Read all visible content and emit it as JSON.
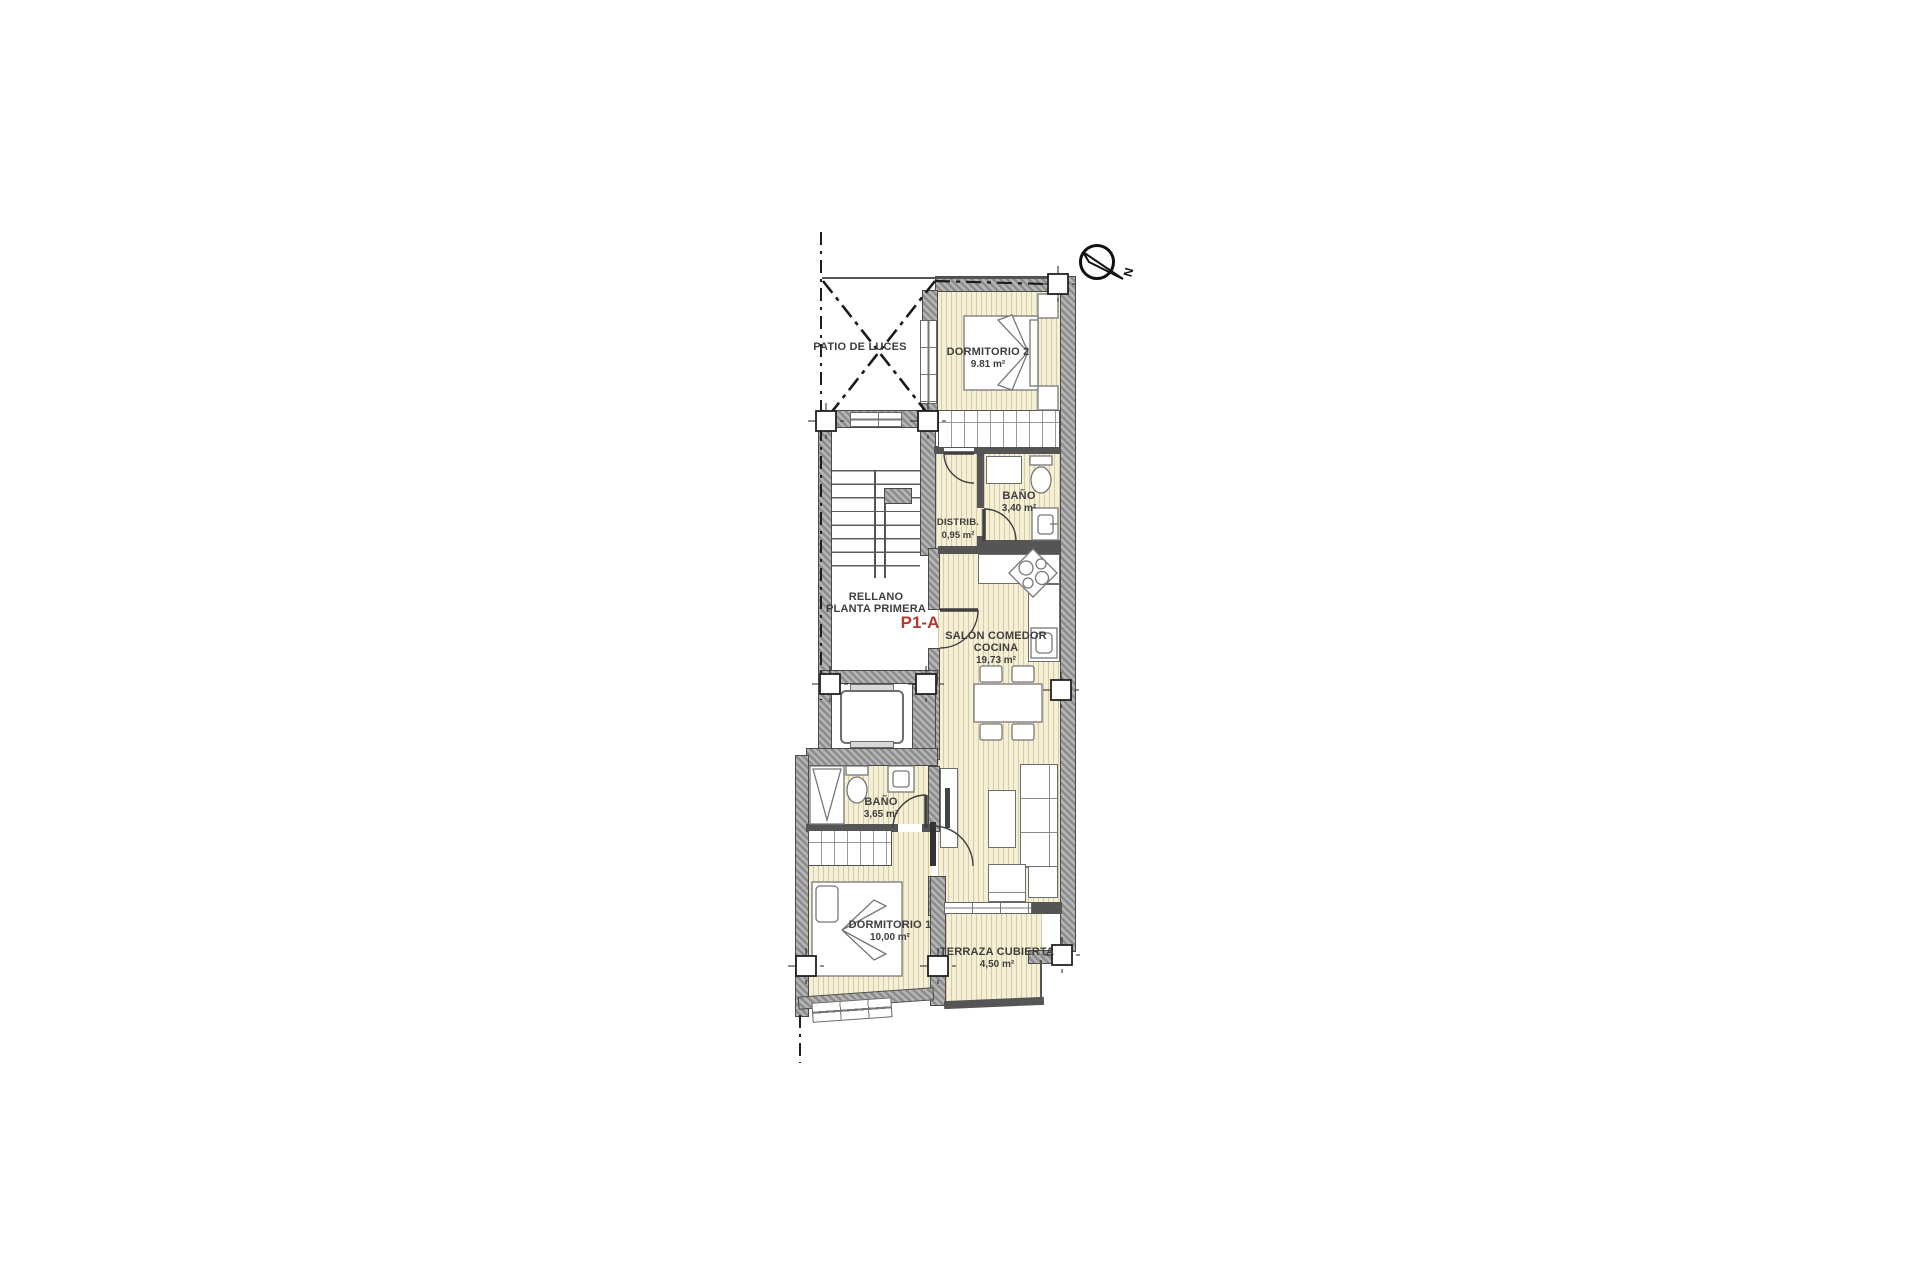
{
  "unit": {
    "code": "P1-A"
  },
  "compass": {
    "label": "N"
  },
  "rooms": {
    "patio": {
      "name": "PATIO DE LUCES"
    },
    "dormitorio2": {
      "name": "DORMITORIO 2",
      "area": "9.81 m²"
    },
    "bano1": {
      "name": "BAÑO",
      "area": "3,40 m²"
    },
    "distribuidor": {
      "name": "DISTRIB.",
      "area": "0,95 m²"
    },
    "rellano": {
      "name_line1": "RELLANO",
      "name_line2": "PLANTA PRIMERA"
    },
    "salon": {
      "name_line1": "SALÓN COMEDOR",
      "name_line2": "COCINA",
      "area": "19,73 m²"
    },
    "bano2": {
      "name": "BAÑO",
      "area": "3,65 m²"
    },
    "dormitorio1": {
      "name": "DORMITORIO 1",
      "area": "10,00 m²"
    },
    "terraza": {
      "name": "TERRAZA CUBIERTA",
      "area": "4,50 m²"
    }
  },
  "colors": {
    "floor": "#f5efd5",
    "floor_stripe": "#9e925a",
    "wall_gray": "#8c8c8c",
    "line": "#3f3f3f",
    "accent_red": "#b23b31"
  }
}
